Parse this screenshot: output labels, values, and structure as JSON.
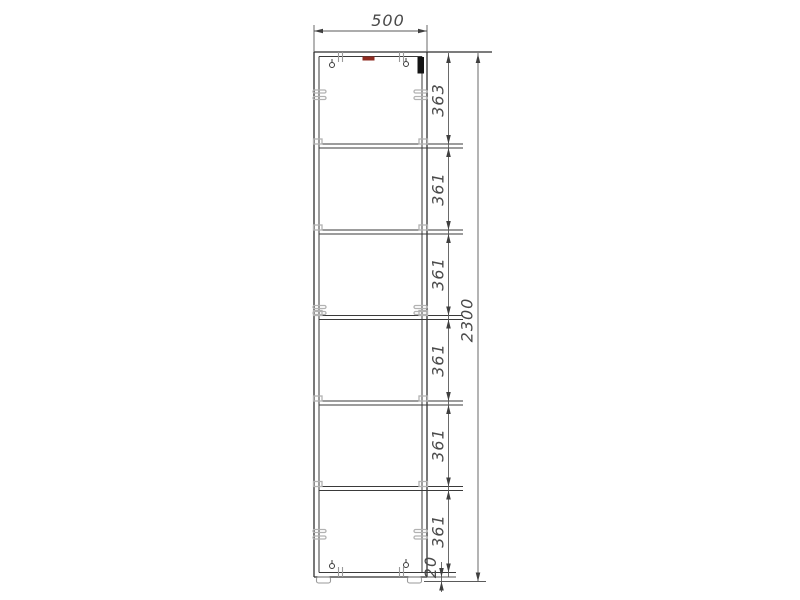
{
  "drawing": {
    "description": "front elevation of tall six-compartment cabinet",
    "dims": {
      "width": "500",
      "total_height": "2300",
      "sections": [
        "363",
        "361",
        "361",
        "361",
        "361",
        "361"
      ],
      "foot": "20"
    },
    "colors": {
      "outline": "#2f2f2f",
      "dimension": "#5a5a5a",
      "fitting_gray": "#b2b2b2",
      "marker_red": "#8f2b20",
      "hinge_black": "#141414",
      "background": "#ffffff"
    }
  }
}
